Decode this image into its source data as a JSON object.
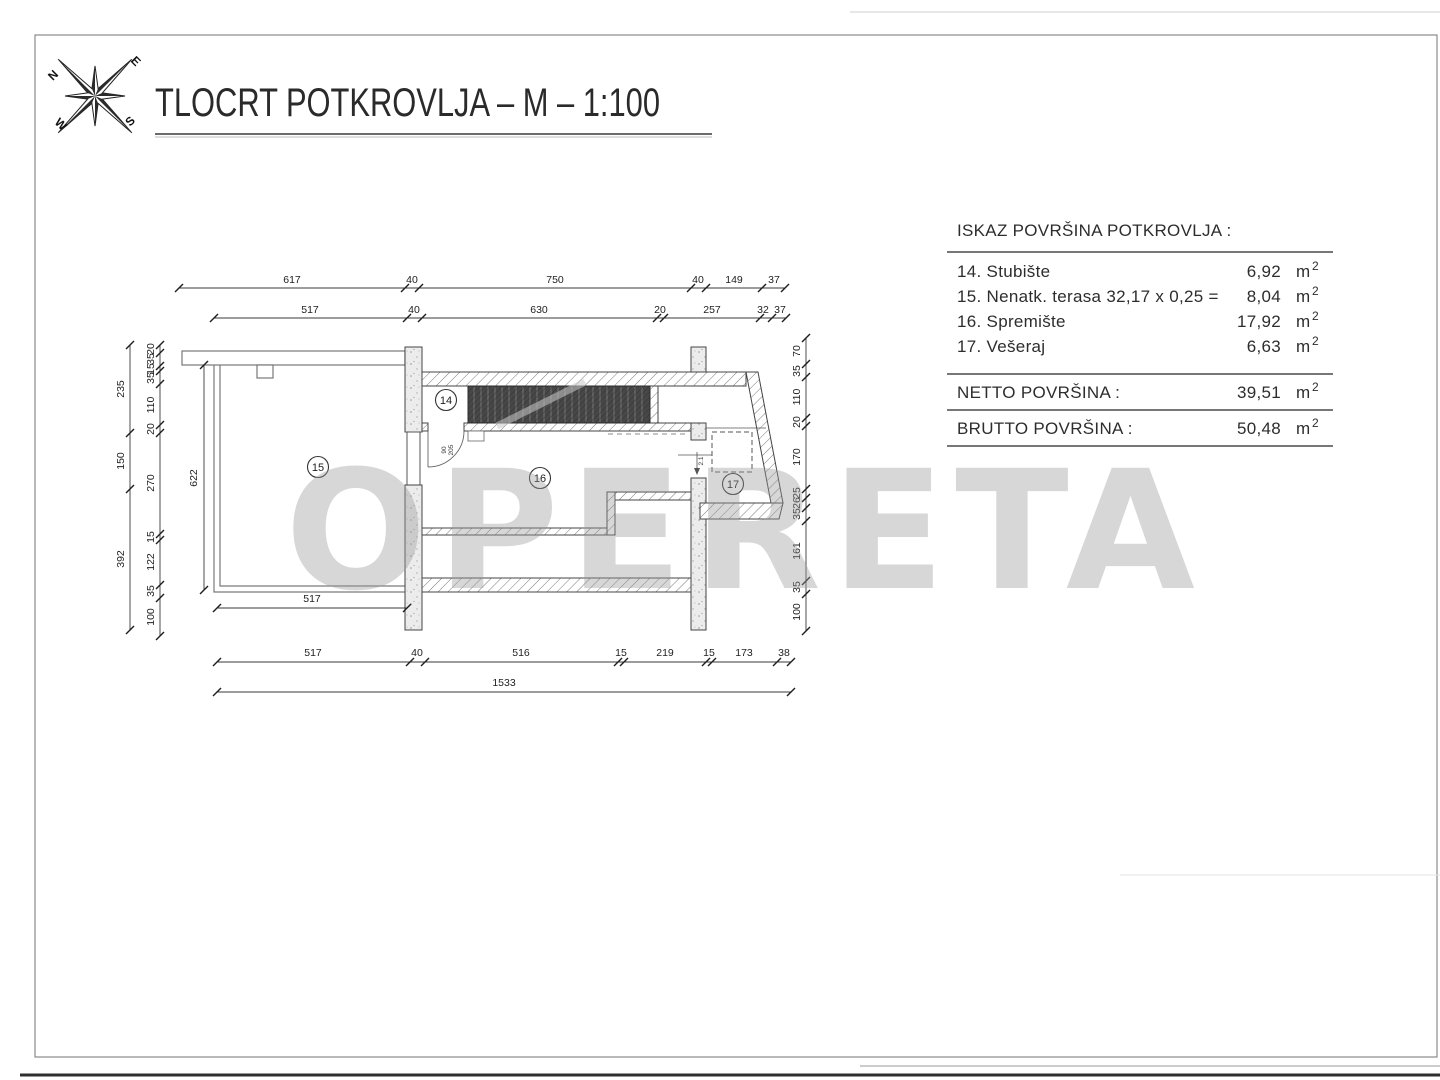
{
  "title": "TLOCRT POTKROVLJA  –  M  –  1:100",
  "watermark": "OPERETA",
  "compass": {
    "n": "N",
    "e": "E",
    "s": "S",
    "w": "W"
  },
  "areas_table": {
    "header": "ISKAZ POVRŠINA POTKROVLJA :",
    "unit": "m",
    "unit_exp": "2",
    "rows": [
      {
        "label": "14. Stubište",
        "value": "6,92"
      },
      {
        "label": "15. Nenatk. terasa 32,17 x 0,25 =",
        "value": "8,04"
      },
      {
        "label": "16. Spremište",
        "value": "17,92"
      },
      {
        "label": "17. Vešeraj",
        "value": "6,63"
      }
    ],
    "netto": {
      "label": "NETTO POVRŠINA :",
      "value": "39,51"
    },
    "brutto": {
      "label": "BRUTTO POVRŠINA :",
      "value": "50,48"
    }
  },
  "plan": {
    "room_badges": [
      {
        "id": "14",
        "x": 446,
        "y": 400
      },
      {
        "id": "15",
        "x": 318,
        "y": 467
      },
      {
        "id": "16",
        "x": 540,
        "y": 478
      },
      {
        "id": "17",
        "x": 733,
        "y": 484
      }
    ],
    "door_label": {
      "width": "90",
      "height": "205"
    },
    "height_note": {
      "text": "2.1"
    },
    "dim_rows": [
      {
        "dir": "h",
        "pos": 288,
        "off": -5,
        "ticks": [
          179,
          405,
          419,
          691,
          706,
          762,
          785
        ],
        "labels": [
          {
            "t": "617",
            "at": 292
          },
          {
            "t": "40",
            "at": 412
          },
          {
            "t": "750",
            "at": 555
          },
          {
            "t": "40",
            "at": 698
          },
          {
            "t": "149",
            "at": 734
          },
          {
            "t": "37",
            "at": 774
          }
        ]
      },
      {
        "dir": "h",
        "pos": 318,
        "off": -5,
        "ticks": [
          214,
          407,
          422,
          657,
          664,
          760,
          772,
          786
        ],
        "labels": [
          {
            "t": "517",
            "at": 310
          },
          {
            "t": "40",
            "at": 414
          },
          {
            "t": "630",
            "at": 539
          },
          {
            "t": "20",
            "at": 660
          },
          {
            "t": "257",
            "at": 712
          },
          {
            "t": "32",
            "at": 763
          },
          {
            "t": "37",
            "at": 780
          }
        ]
      },
      {
        "dir": "h",
        "pos": 662,
        "off": -6,
        "ticks": [
          217,
          410,
          425,
          618,
          624,
          706,
          712,
          777,
          791
        ],
        "labels": [
          {
            "t": "517",
            "at": 313
          },
          {
            "t": "40",
            "at": 417
          },
          {
            "t": "516",
            "at": 521
          },
          {
            "t": "15",
            "at": 621
          },
          {
            "t": "219",
            "at": 665
          },
          {
            "t": "15",
            "at": 709
          },
          {
            "t": "173",
            "at": 744
          },
          {
            "t": "38",
            "at": 784
          }
        ]
      },
      {
        "dir": "h",
        "pos": 692,
        "off": -6,
        "ticks": [
          217,
          791
        ],
        "labels": [
          {
            "t": "1533",
            "at": 504
          }
        ]
      },
      {
        "dir": "h",
        "pos": 608,
        "off": -6,
        "ticks": [
          217,
          407
        ],
        "labels": [
          {
            "t": "517",
            "at": 312
          }
        ]
      },
      {
        "dir": "v",
        "pos": 130,
        "off": -6,
        "ticks": [
          345,
          433,
          489,
          630
        ],
        "labels": [
          {
            "t": "235",
            "at": 389
          },
          {
            "t": "150",
            "at": 461
          },
          {
            "t": "392",
            "at": 559
          }
        ]
      },
      {
        "dir": "v",
        "pos": 160,
        "off": -6,
        "ticks": [
          345,
          353,
          366,
          371,
          384,
          425,
          433,
          534,
          540,
          585,
          598,
          636
        ],
        "labels": [
          {
            "t": "20",
            "at": 349
          },
          {
            "t": "35",
            "at": 359
          },
          {
            "t": "15",
            "at": 369
          },
          {
            "t": "35",
            "at": 378
          },
          {
            "t": "110",
            "at": 405
          },
          {
            "t": "20",
            "at": 429
          },
          {
            "t": "270",
            "at": 483
          },
          {
            "t": "15",
            "at": 537
          },
          {
            "t": "122",
            "at": 562
          },
          {
            "t": "35",
            "at": 591
          },
          {
            "t": "100",
            "at": 617
          }
        ]
      },
      {
        "dir": "v",
        "pos": 806,
        "off": -6,
        "ticks": [
          338,
          364,
          377,
          418,
          426,
          489,
          498,
          508,
          521,
          581,
          594,
          631
        ],
        "labels": [
          {
            "t": "70",
            "at": 351
          },
          {
            "t": "35",
            "at": 371
          },
          {
            "t": "110",
            "at": 397
          },
          {
            "t": "20",
            "at": 422
          },
          {
            "t": "170",
            "at": 457
          },
          {
            "t": "25",
            "at": 493
          },
          {
            "t": "26",
            "at": 503
          },
          {
            "t": "35",
            "at": 514
          },
          {
            "t": "161",
            "at": 551
          },
          {
            "t": "35",
            "at": 587
          },
          {
            "t": "100",
            "at": 612
          }
        ]
      },
      {
        "dir": "v",
        "pos": 204,
        "off": -7,
        "ticks": [
          365,
          590
        ],
        "labels": [
          {
            "t": "622",
            "at": 478
          }
        ]
      }
    ]
  }
}
